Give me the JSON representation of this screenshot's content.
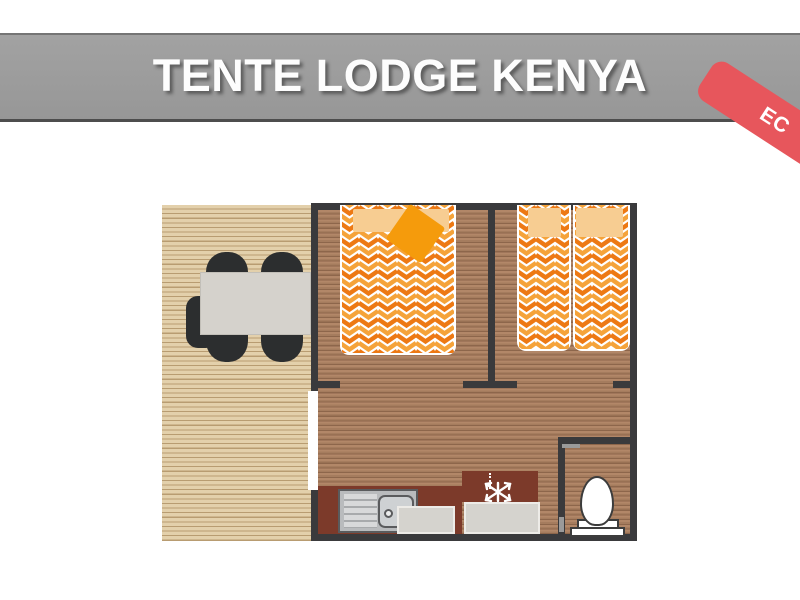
{
  "header": {
    "title": "TENTE LODGE KENYA",
    "badge_label": "EC"
  },
  "colors": {
    "banner_gray": "#9c9c9c",
    "badge_red": "#e7565c",
    "wall_dark": "#3a3a3c",
    "deck_wood": "#ddc8a0",
    "interior_wood": "#a57c5e",
    "counter_maroon": "#7c3a2a",
    "bed_chevron_orange": "#ed7914",
    "bed_chevron_amber": "#f5a33a",
    "pillow_peach": "#f7cd92",
    "throw_orange": "#f59b0c",
    "appliance_gray": "#d5d3ce"
  },
  "plan": {
    "areas": [
      "terrace-deck",
      "bedroom-double",
      "bedroom-twin",
      "living-kitchen",
      "bathroom"
    ],
    "furniture": [
      "dining-table",
      "chairs",
      "end-bench",
      "double-bed",
      "single-beds",
      "pillows",
      "orange-plaid",
      "kitchen-counter",
      "sink",
      "fridge-freezer",
      "appliances",
      "toilet"
    ]
  },
  "icons": {
    "snowflake": "snowflake-icon"
  }
}
